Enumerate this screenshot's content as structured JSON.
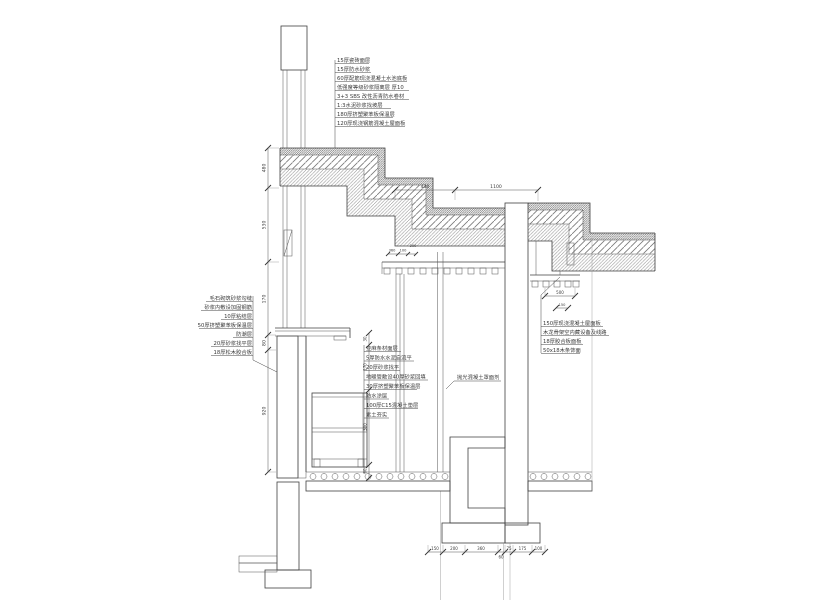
{
  "drawing": {
    "type": "architectural-wall-section-detail",
    "labels": {
      "roof_layers": [
        "15厚瓷砖面层",
        "15厚防水砂浆",
        "60厚配筋现浇混凝土水池底板",
        "低强度等级砂浆隔离层 厚10",
        "3+3 SBS 改性沥青防水卷材",
        "1:3水泥砂浆找坡层",
        "180厚挤塑聚苯板保温层",
        "120厚现浇钢筋混凝土屋面板"
      ],
      "left_wall_layers": [
        "毛石砌筑砂浆勾缝",
        "砂浆内敷设加固钢筋",
        "10厚粘结层",
        "50厚挤塑聚苯板保温层",
        "防潮层",
        "20厚砂浆找平层",
        "18厚松木胶合板"
      ],
      "floor_layers": [
        "亚麻条材面层",
        "5厚防水水泥自流平",
        "20厚砂浆找平",
        "地暖管敷设40厚砂浆回填",
        "30厚挤塑聚苯板保温层",
        "防水涂层",
        "100厚C15混凝土垫层",
        "素土夯实"
      ],
      "right_ceiling_layers": [
        "150厚现浇混凝土屋面板",
        "木龙骨架空内藏设备及线路",
        "18厚胶合板面板",
        "50x18木条饰面"
      ],
      "wall_finish": "抛光混凝土罩面剂"
    },
    "dimensions": {
      "top": [
        "430",
        "1100"
      ],
      "left": [
        "480",
        "530",
        "170",
        "80",
        "920"
      ],
      "middle": [
        "30",
        "170",
        "300",
        "60"
      ],
      "bottom": [
        "150",
        "200",
        "360",
        "60",
        "75",
        "175",
        "100"
      ],
      "right_ceiling": [
        "500",
        "150"
      ],
      "window": [
        "360",
        "100",
        "200"
      ]
    },
    "colors": {
      "line": "#3f3f3f",
      "hatch": "#777777",
      "text": "#3a3a3a",
      "background": "#ffffff"
    }
  }
}
